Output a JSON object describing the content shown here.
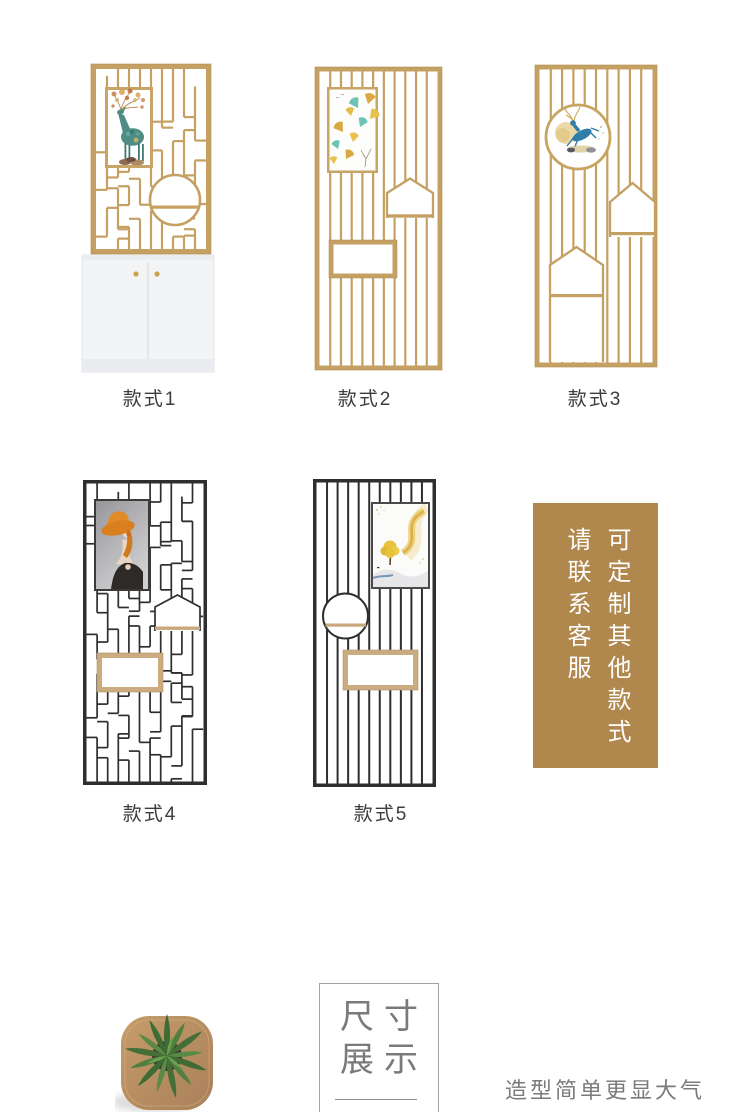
{
  "section_styles": {
    "items": [
      {
        "label": "款式1"
      },
      {
        "label": "款式2"
      },
      {
        "label": "款式3"
      },
      {
        "label": "款式4"
      },
      {
        "label": "款式5"
      }
    ]
  },
  "notice": {
    "line_right": "可定制其他款式",
    "line_left": "请联系客服"
  },
  "size_section": {
    "title_row1": "尺寸",
    "title_row2": "展示",
    "caption": "造型简单更显大气"
  },
  "icons": {
    "plant": "potted-plant-top-view",
    "screens": [
      "gold-irregular-screen-with-cabinet",
      "gold-bar-screen",
      "gold-bar-screen-round-art",
      "black-irregular-screen",
      "black-bar-screen"
    ]
  },
  "colors": {
    "gold": "#c5a063",
    "black_frame": "#2e2e2e",
    "wood": "#c9a87c",
    "notice_bg": "#b0874d",
    "notice_text": "#ffffff",
    "label_text": "#3c3c3c",
    "muted_text": "#7a7a7a",
    "cabinet_white": "#f3f4f6"
  }
}
